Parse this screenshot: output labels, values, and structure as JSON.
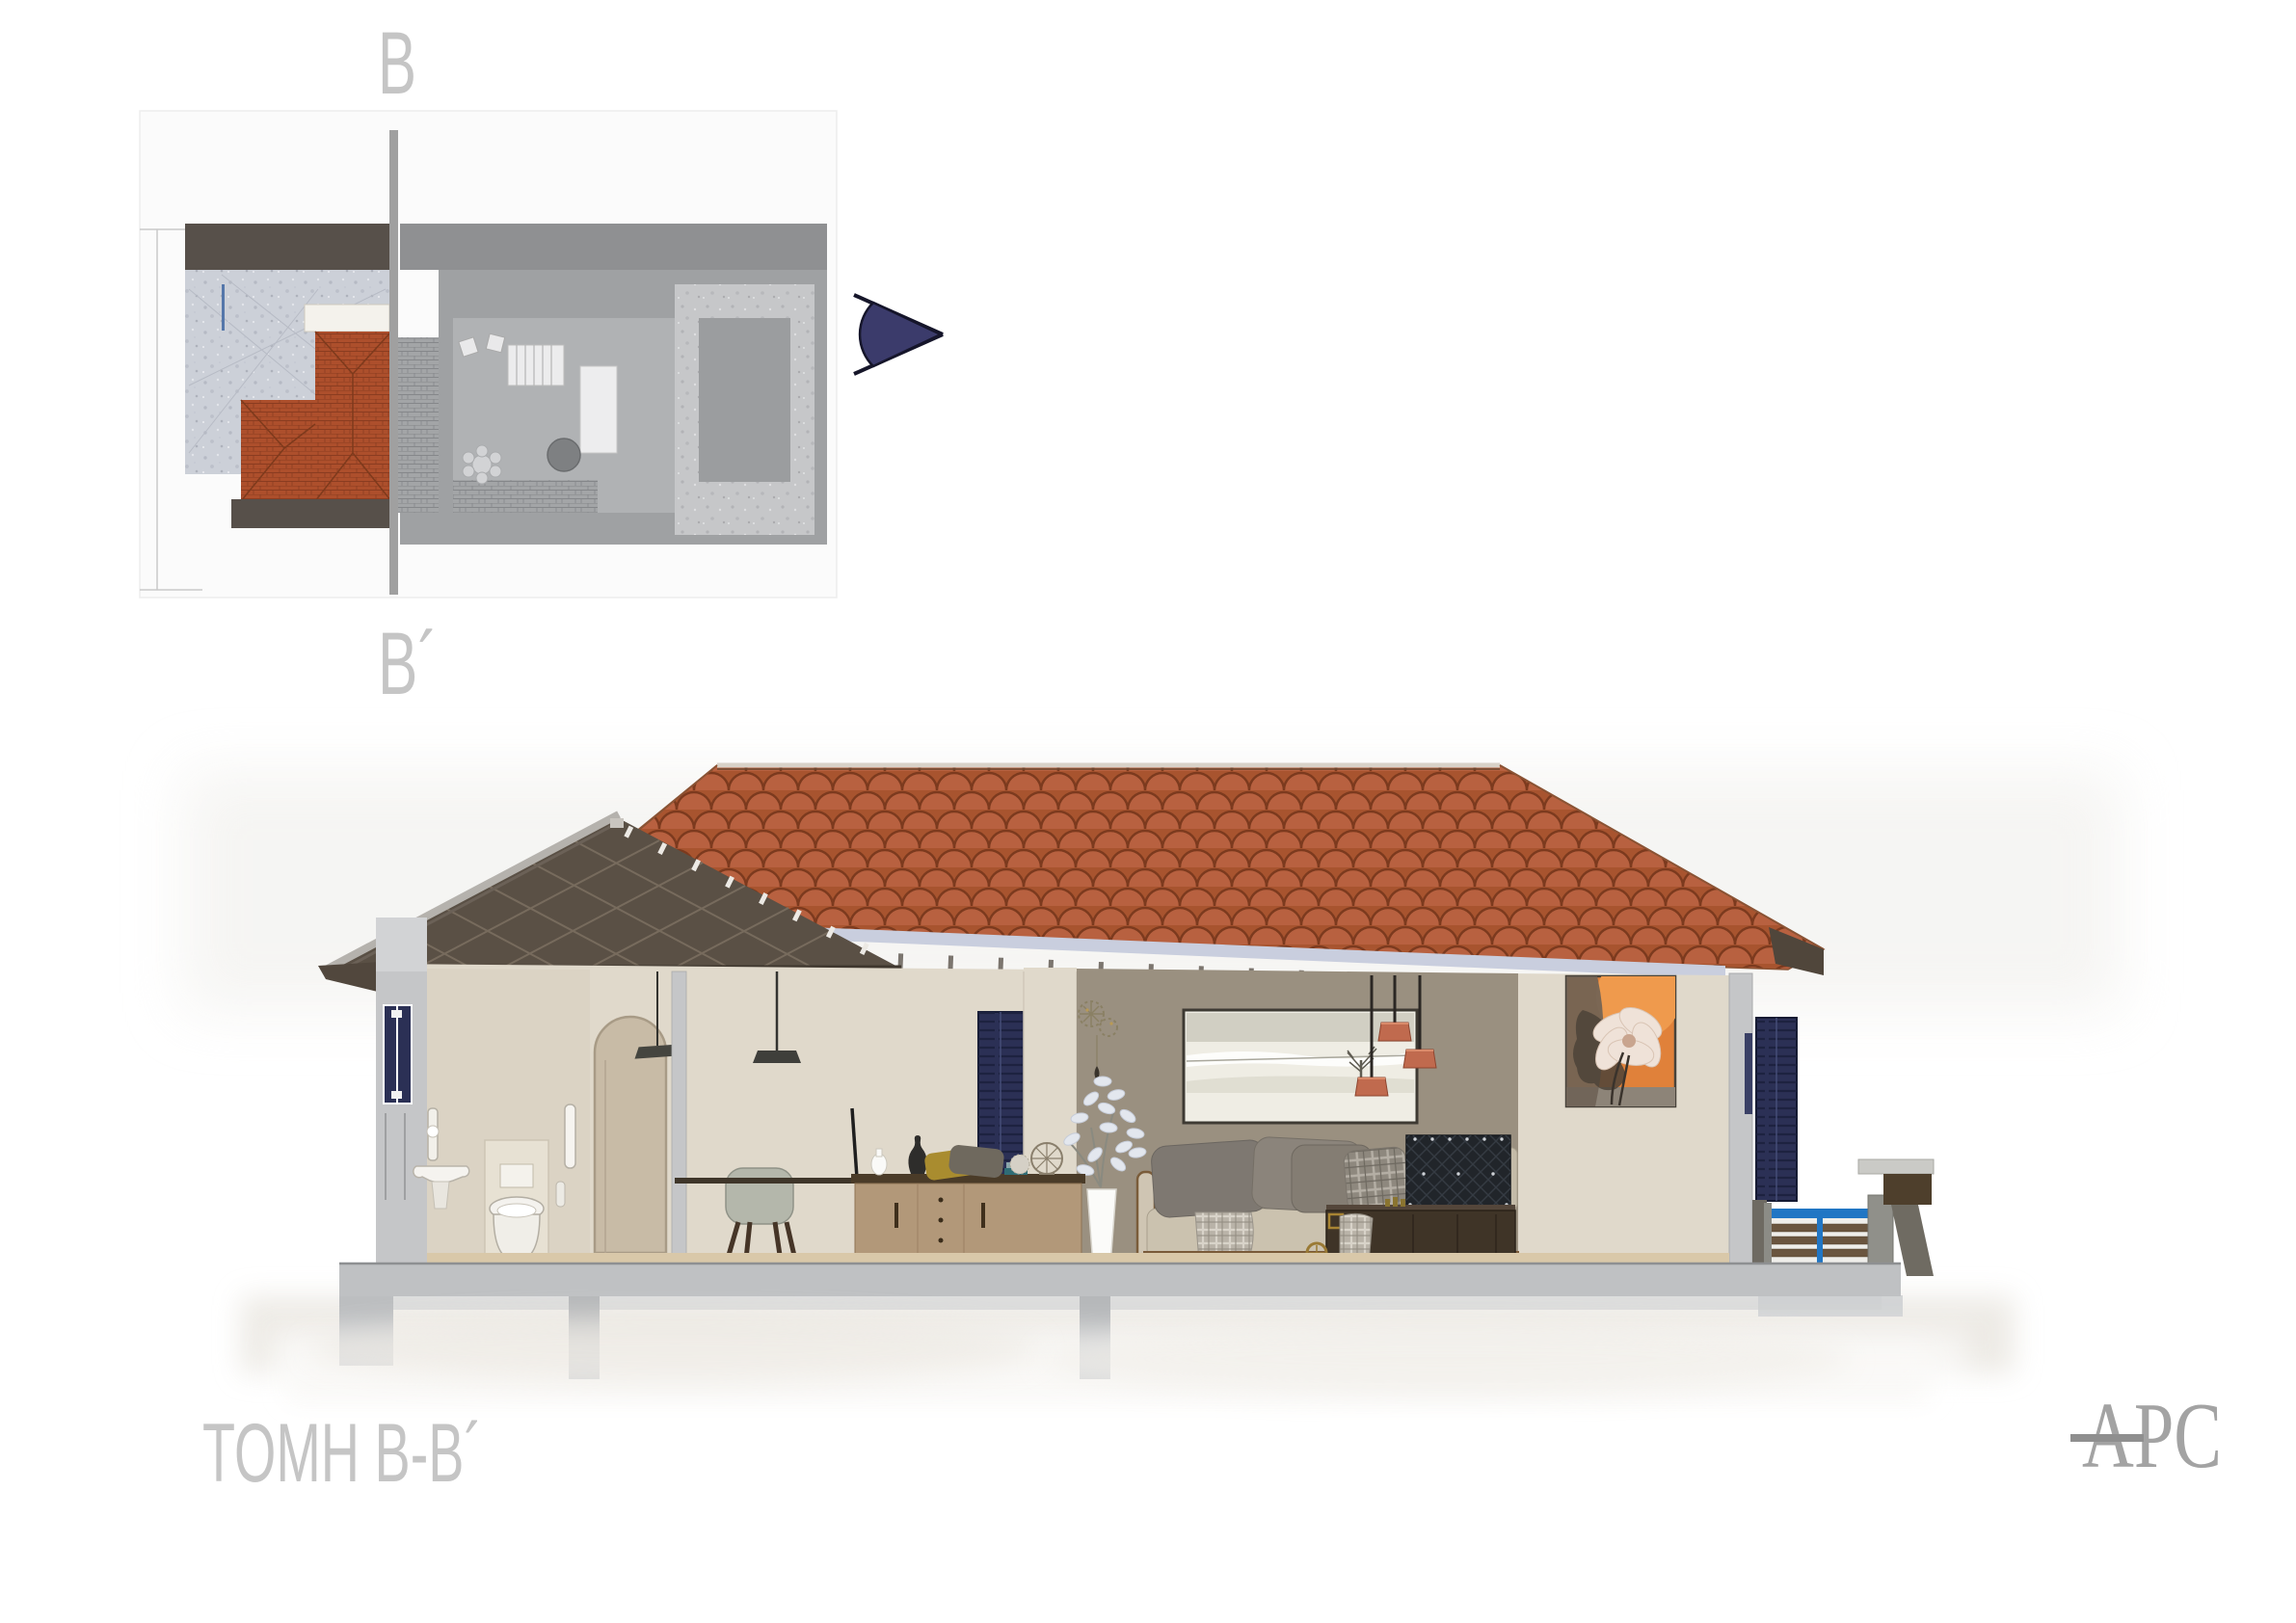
{
  "document": {
    "kind": "architectural section sheet",
    "background": "#ffffff"
  },
  "plan": {
    "section_label_top": "B",
    "section_label_bottom": "B´"
  },
  "section": {
    "title": "ΤΟΜΗ B-B´"
  },
  "logo": {
    "monogram": "APC"
  },
  "icons": {
    "view_direction": "section-view-direction-arrow-right",
    "plan_cut_line": "section-cut-line"
  },
  "colors": {
    "page_bg": "#ffffff",
    "label_gray": "#c5c5c5",
    "logo_gray": "#a3a3a3",
    "arrow_navy": "#3b3b6b",
    "roof_tile": "#ad5a33",
    "roof_tile_shadow": "#7c3a1e",
    "roof_wood": "#5a5045",
    "eave_gutter": "#c9cede",
    "wall_beige": "#e0d9cb",
    "wall_beige_warm": "#dbd3c4",
    "wall_taupe": "#9a9080",
    "cut_gray": "#c5c6c8",
    "navy": "#2b3055",
    "pendant": "#c06a4e",
    "rail_blue": "#2176c4",
    "slat_brown": "#6a553f",
    "foundation": "#bfc1c3",
    "floor_tan": "#d9c8a9",
    "plan_red": "#ad4f2c",
    "plan_band_dark": "#57504a",
    "plan_band_gray": "#8f9092",
    "line_gray": "#a0a0a0"
  }
}
